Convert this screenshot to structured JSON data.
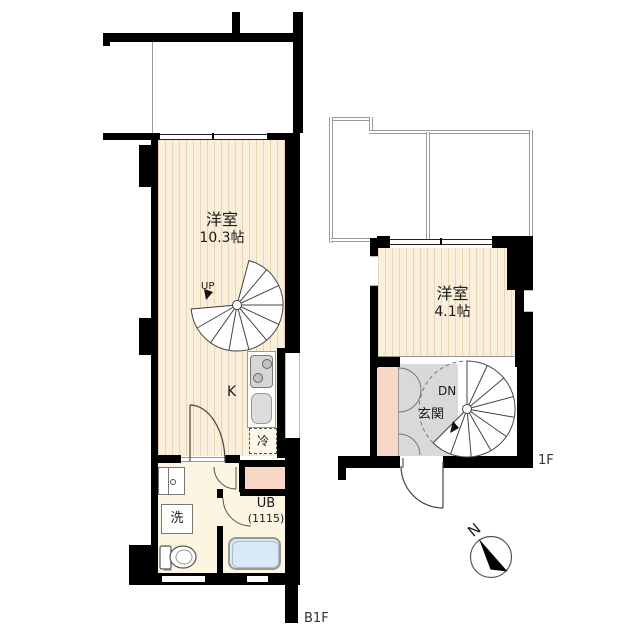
{
  "b1f": {
    "floor_label": "B1F",
    "room_name": "洋室",
    "room_size": "10.3帖",
    "stair_direction": "UP",
    "kitchen_label": "K",
    "refrigerator_label": "冷",
    "washer_label": "洗",
    "unit_bath_label": "UB",
    "unit_bath_size": "(1115)"
  },
  "f1": {
    "floor_label": "1F",
    "room_name": "洋室",
    "room_size": "4.1帖",
    "stair_direction": "DN",
    "entrance_label": "玄関"
  },
  "compass": {
    "north_label": "N"
  },
  "colors": {
    "wall": "#000000",
    "wood_floor": "#f9efdb",
    "wood_stripe": "#e7d5b6",
    "plain_floor": "#fbf5e2",
    "closet": "#f8d7c6",
    "entrance_gray": "#d9d9d9",
    "bathtub": "#d9e9f7"
  }
}
